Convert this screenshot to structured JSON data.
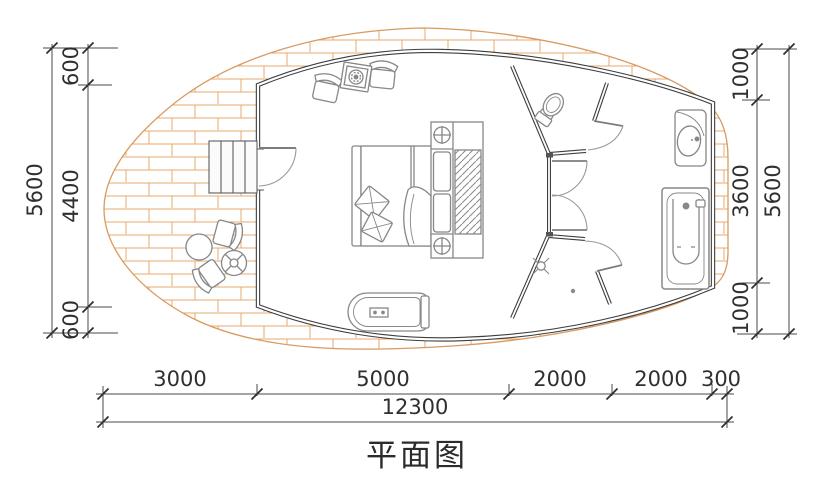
{
  "title": "平面图",
  "dimensions": {
    "left": {
      "total": "5600",
      "segments": [
        "600",
        "4400",
        "600"
      ]
    },
    "right": {
      "total": "5600",
      "segments": [
        "1000",
        "3600",
        "1000"
      ]
    },
    "bottom": {
      "total": "12300",
      "segments": [
        "3000",
        "5000",
        "2000",
        "2000",
        "300"
      ]
    }
  },
  "colors": {
    "brick": "#e7a96e",
    "wall": "#3d3d3d",
    "furniture": "#878787",
    "dimension": "#4a4a4a",
    "text": "#2f2f2f"
  },
  "fixtures": [
    "entry-steps",
    "entry-door",
    "armchair",
    "stove-table",
    "double-bed",
    "pillow",
    "wardrobe",
    "downlight",
    "freestanding-tub",
    "double-swing-doors",
    "toilet",
    "shower-head",
    "floor-drain",
    "vanity-sink",
    "bathtub",
    "outdoor-armchair",
    "outdoor-round-table",
    "outdoor-parasol-table"
  ]
}
